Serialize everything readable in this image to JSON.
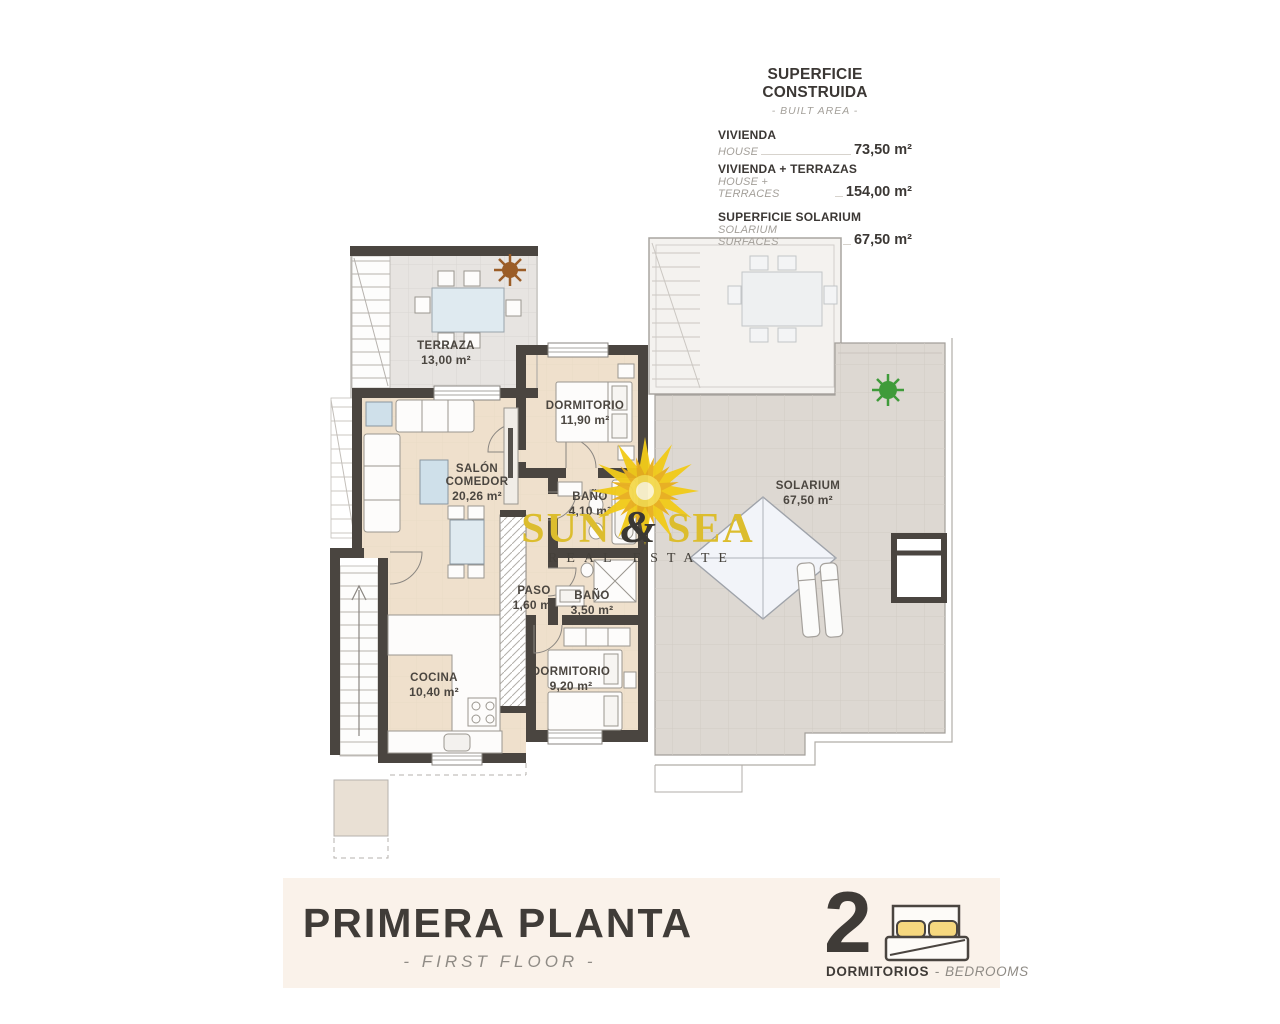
{
  "area_table": {
    "title": "SUPERFICIE CONSTRUIDA",
    "subtitle": "- BUILT AREA -",
    "rows": [
      {
        "label": "VIVIENDA",
        "sublabel": "HOUSE",
        "value": "73,50 m²"
      },
      {
        "label": "VIVIENDA + TERRAZAS",
        "sublabel": "HOUSE + TERRACES",
        "value": "154,00 m²"
      },
      {
        "label": "SUPERFICIE SOLARIUM",
        "sublabel": "SOLARIUM SURFACES",
        "value": "67,50 m²"
      }
    ]
  },
  "rooms": [
    {
      "name": "TERRAZA",
      "area": "13,00 m²"
    },
    {
      "name": "DORMITORIO",
      "area": "11,90 m²"
    },
    {
      "name": "SALÓN COMEDOR",
      "area": "20,26 m²"
    },
    {
      "name": "BAÑO",
      "area": "4,10 m²"
    },
    {
      "name": "PASO",
      "area": "1,60 m²"
    },
    {
      "name": "BAÑO",
      "area": "3,50 m²"
    },
    {
      "name": "COCINA",
      "area": "10,40 m²"
    },
    {
      "name": "DORMITORIO",
      "area": "9,20 m²"
    },
    {
      "name": "SOLARIUM",
      "area": "67,50 m²"
    }
  ],
  "watermark": {
    "word1": "SUN",
    "ampersand": "&",
    "word2": "SEA",
    "tagline": "REAL ESTATE",
    "icon": "sun-logo-icon"
  },
  "footer": {
    "title": "PRIMERA PLANTA",
    "subtitle": "- FIRST FLOOR -",
    "bedrooms": {
      "count": "2",
      "label_es": "DORMITORIOS",
      "separator": "-",
      "label_en": "BEDROOMS",
      "icon": "double-bed-icon"
    }
  },
  "colors": {
    "wall": "#4a4540",
    "house_floor": "#efe0cc",
    "terrace_floor": "#e7e4e1",
    "solarium_floor": "#ddd8d2",
    "upper_terrace": "#f4f2ef",
    "footer_band": "#faf2ea",
    "accent_yellow": "#dcbd2e",
    "pillow_yellow": "#f6d87f",
    "plant_green": "#3f9b3a",
    "plant_brown": "#9b5d27",
    "text_dark": "#3b3734",
    "text_muted": "#a39f99"
  }
}
